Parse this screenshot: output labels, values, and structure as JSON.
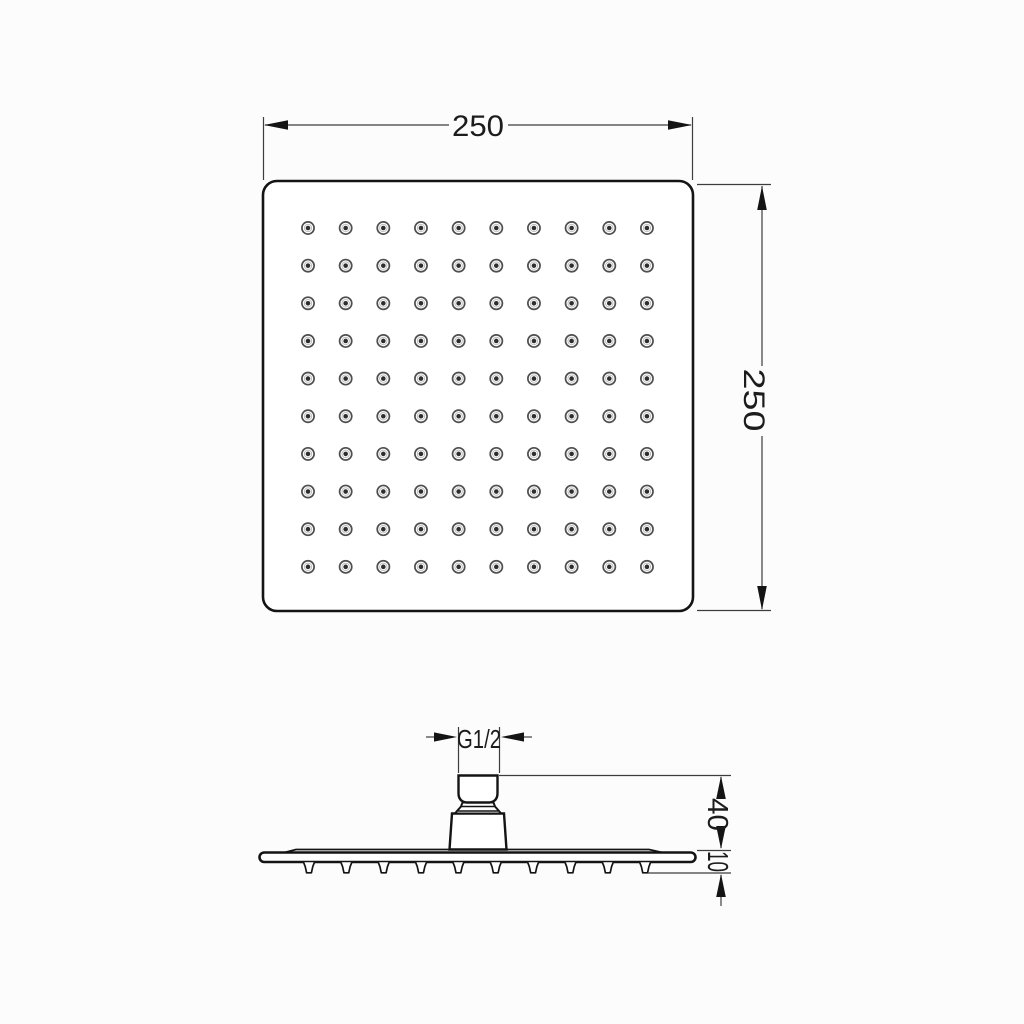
{
  "drawing": {
    "type": "technical-drawing",
    "subject": "square rain shower head",
    "colors": {
      "background": "#fcfcfc",
      "outline": "#141414",
      "dimension_lines": "#3d3d3d",
      "text": "#1c1c1c",
      "nozzle_ring": "#4f4f4f",
      "nozzle_center": "#2e2e2e"
    },
    "top_view": {
      "width_label": "250",
      "height_label": "250",
      "nozzle_grid": {
        "rows": 10,
        "cols": 10
      }
    },
    "side_view": {
      "thread_label": "G1/2",
      "connector_height_label": "40",
      "plate_thickness_label": "10",
      "nozzle_count": 10
    }
  }
}
